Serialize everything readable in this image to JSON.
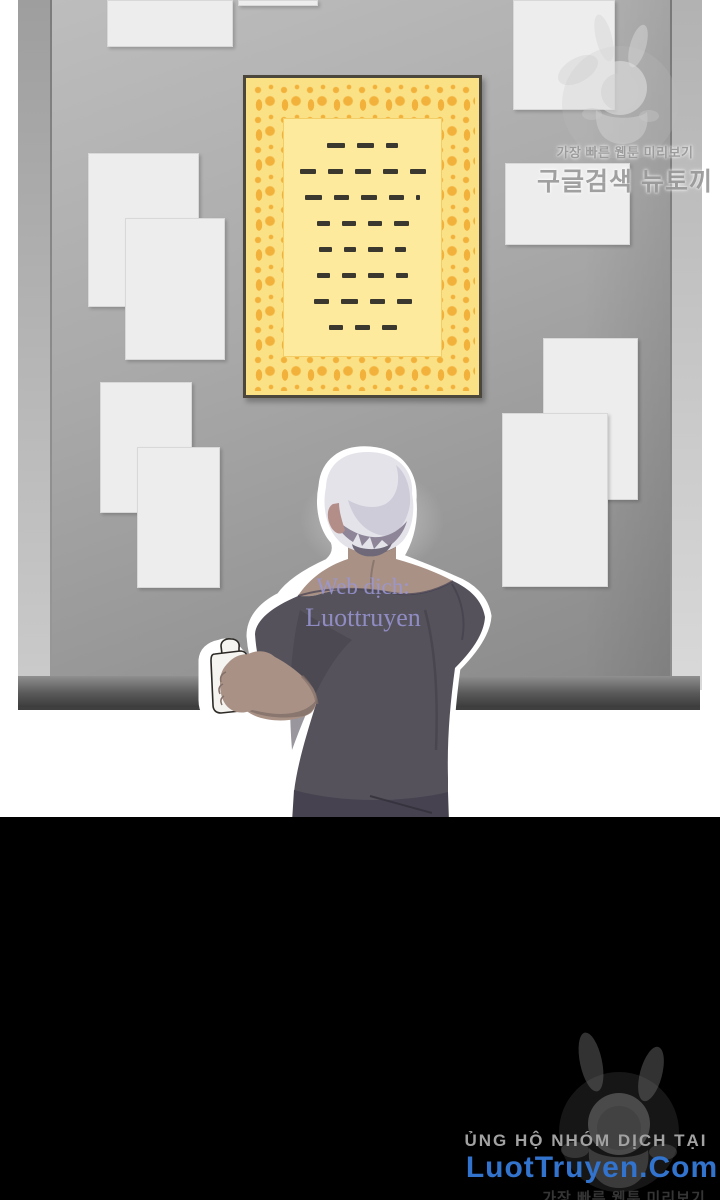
{
  "colors": {
    "board-surface-a": "#bdbdbd",
    "board-surface-b": "#8a8a8a",
    "board-edge-left-a": "#9e9e9e",
    "board-edge-left-b": "#cacaca",
    "board-edge-right-a": "#b2b2b2",
    "board-edge-right-b": "#d9d9d9",
    "paper": "#ededed",
    "paper-edge": "#d8d8d8",
    "poster-border": "#4b473c",
    "poster-base": "#fbe186",
    "poster-inner": "#fdea9c",
    "poster-ornament": "#f2ac32",
    "dash": "#3b392f",
    "hair-light": "#e4e3ea",
    "hair-mid": "#c9c6d4",
    "hair-dark": "#8e8698",
    "hair-deep": "#6e6878",
    "skin": "#a99186",
    "skin-shadow": "#84716a",
    "shirt": "#56525c",
    "shirt-dark": "#45414d",
    "pants": "#474250",
    "can": "#f5f4f0",
    "wm-purple": "#9a97d6",
    "wm-top-gray": "#9a9a9a",
    "footer-support": "#a2a2a2",
    "footer-site": "#3273cd",
    "footer-faint": "#353535",
    "black": "#000000"
  },
  "board": {
    "papers": [
      {
        "x": 107,
        "y": 0,
        "w": 126,
        "h": 47
      },
      {
        "x": 238,
        "y": 0,
        "w": 80,
        "h": 6
      },
      {
        "x": 513,
        "y": 0,
        "w": 102,
        "h": 110
      },
      {
        "x": 88,
        "y": 153,
        "w": 111,
        "h": 154
      },
      {
        "x": 125,
        "y": 218,
        "w": 100,
        "h": 142
      },
      {
        "x": 505,
        "y": 163,
        "w": 125,
        "h": 82
      },
      {
        "x": 100,
        "y": 382,
        "w": 92,
        "h": 131
      },
      {
        "x": 137,
        "y": 447,
        "w": 83,
        "h": 141
      },
      {
        "x": 543,
        "y": 338,
        "w": 95,
        "h": 162
      },
      {
        "x": 502,
        "y": 413,
        "w": 106,
        "h": 174
      }
    ]
  },
  "poster": {
    "dash_rows": [
      [
        18,
        17,
        12
      ],
      [
        16,
        15,
        16,
        15,
        16
      ],
      [
        17,
        15,
        16,
        15,
        4
      ],
      [
        13,
        14,
        14,
        15
      ],
      [
        13,
        12,
        15,
        11
      ],
      [
        13,
        14,
        16,
        12
      ],
      [
        15,
        17,
        15,
        15
      ],
      [
        14,
        15,
        15
      ]
    ]
  },
  "watermark_top": {
    "line1": "가장 빠른 웹툰 미리보기",
    "line2": "구글검색 뉴토끼"
  },
  "watermark_translator": {
    "line1": "Web dịch:",
    "line2": "Luottruyen"
  },
  "footer": {
    "support": "ỦNG HỘ NHÓM DỊCH TẠI",
    "site": "LuotTruyen.Com",
    "watermark": "가장 빠른 웹툰 미리보기"
  }
}
